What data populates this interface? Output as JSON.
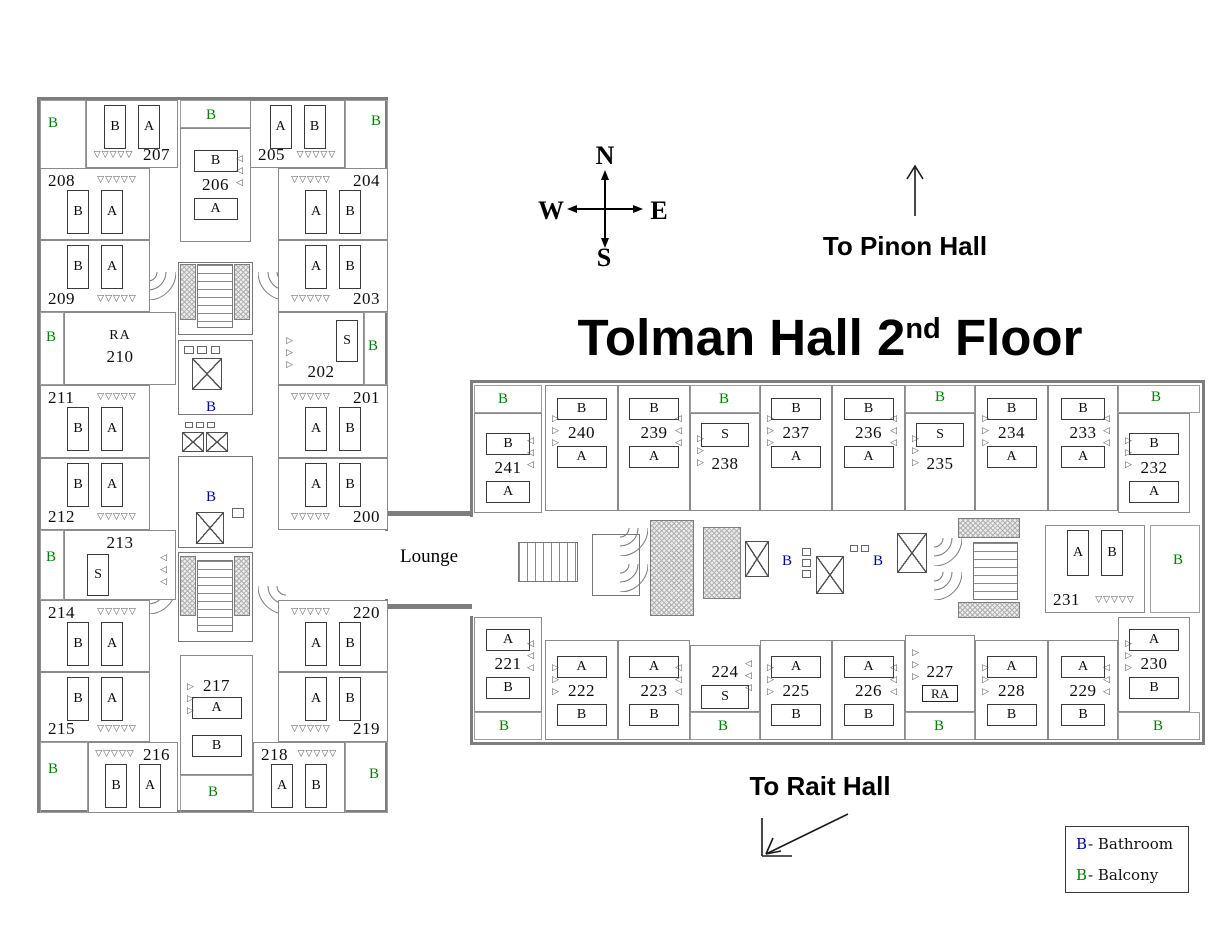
{
  "title": {
    "before_sup": "Tolman Hall 2",
    "sup": "nd",
    "after_sup": " Floor"
  },
  "compass": {
    "north": "N",
    "south": "S",
    "west": "W",
    "east": "E"
  },
  "wayfinding": {
    "pinon": "To Pinon Hall",
    "rait": "To Rait Hall"
  },
  "lounge_label": "Lounge",
  "legend": {
    "items": [
      {
        "symbol": "B",
        "label": "- Bathroom",
        "color": "#00009c"
      },
      {
        "symbol": "B",
        "label": "- Balcony",
        "color": "#008000"
      }
    ]
  },
  "symbols": {
    "bathroom": "B",
    "balcony": "B",
    "ra": "RA",
    "bed_a": "A",
    "bed_b": "B",
    "single": "S"
  },
  "colors": {
    "wall": "#7d7d7d",
    "ink": "#0d0d0d",
    "bathroom_blue": "#00009c",
    "balcony_green": "#008000"
  },
  "left_wing": {
    "rooms": [
      {
        "num": "200",
        "beds": [
          "A",
          "B"
        ]
      },
      {
        "num": "201",
        "beds": [
          "A",
          "B"
        ]
      },
      {
        "num": "202",
        "beds": [
          "S"
        ]
      },
      {
        "num": "203",
        "beds": [
          "A",
          "B"
        ]
      },
      {
        "num": "204",
        "beds": [
          "A",
          "B"
        ]
      },
      {
        "num": "205",
        "beds": [
          "A",
          "B"
        ]
      },
      {
        "num": "206",
        "beds": [
          "B",
          "A"
        ]
      },
      {
        "num": "207",
        "beds": [
          "B",
          "A"
        ]
      },
      {
        "num": "208",
        "beds": [
          "B",
          "A"
        ]
      },
      {
        "num": "209",
        "beds": [
          "B",
          "A"
        ]
      },
      {
        "num": "210",
        "beds": [],
        "ra": true
      },
      {
        "num": "211",
        "beds": [
          "B",
          "A"
        ]
      },
      {
        "num": "212",
        "beds": [
          "B",
          "A"
        ]
      },
      {
        "num": "213",
        "beds": [
          "S"
        ]
      },
      {
        "num": "214",
        "beds": [
          "B",
          "A"
        ]
      },
      {
        "num": "215",
        "beds": [
          "B",
          "A"
        ]
      },
      {
        "num": "216",
        "beds": [
          "B",
          "A"
        ]
      },
      {
        "num": "217",
        "beds": [
          "A",
          "B"
        ]
      },
      {
        "num": "218",
        "beds": [
          "A",
          "B"
        ]
      },
      {
        "num": "219",
        "beds": [
          "A",
          "B"
        ]
      },
      {
        "num": "220",
        "beds": [
          "A",
          "B"
        ]
      }
    ]
  },
  "right_wing": {
    "rooms": [
      {
        "num": "221",
        "beds": [
          "A",
          "B"
        ]
      },
      {
        "num": "222",
        "beds": [
          "A",
          "B"
        ]
      },
      {
        "num": "223",
        "beds": [
          "A",
          "B"
        ]
      },
      {
        "num": "224",
        "beds": [
          "S"
        ]
      },
      {
        "num": "225",
        "beds": [
          "A",
          "B"
        ]
      },
      {
        "num": "226",
        "beds": [
          "A",
          "B"
        ]
      },
      {
        "num": "227",
        "beds": [],
        "ra": true
      },
      {
        "num": "228",
        "beds": [
          "A",
          "B"
        ]
      },
      {
        "num": "229",
        "beds": [
          "A",
          "B"
        ]
      },
      {
        "num": "230",
        "beds": [
          "A",
          "B"
        ]
      },
      {
        "num": "231",
        "beds": [
          "A",
          "B"
        ]
      },
      {
        "num": "232",
        "beds": [
          "B",
          "A"
        ]
      },
      {
        "num": "233",
        "beds": [
          "B",
          "A"
        ]
      },
      {
        "num": "234",
        "beds": [
          "B",
          "A"
        ]
      },
      {
        "num": "235",
        "beds": [
          "S"
        ]
      },
      {
        "num": "236",
        "beds": [
          "B",
          "A"
        ]
      },
      {
        "num": "237",
        "beds": [
          "B",
          "A"
        ]
      },
      {
        "num": "238",
        "beds": [
          "S"
        ]
      },
      {
        "num": "239",
        "beds": [
          "B",
          "A"
        ]
      },
      {
        "num": "240",
        "beds": [
          "B",
          "A"
        ]
      },
      {
        "num": "241",
        "beds": [
          "B",
          "A"
        ]
      }
    ]
  }
}
